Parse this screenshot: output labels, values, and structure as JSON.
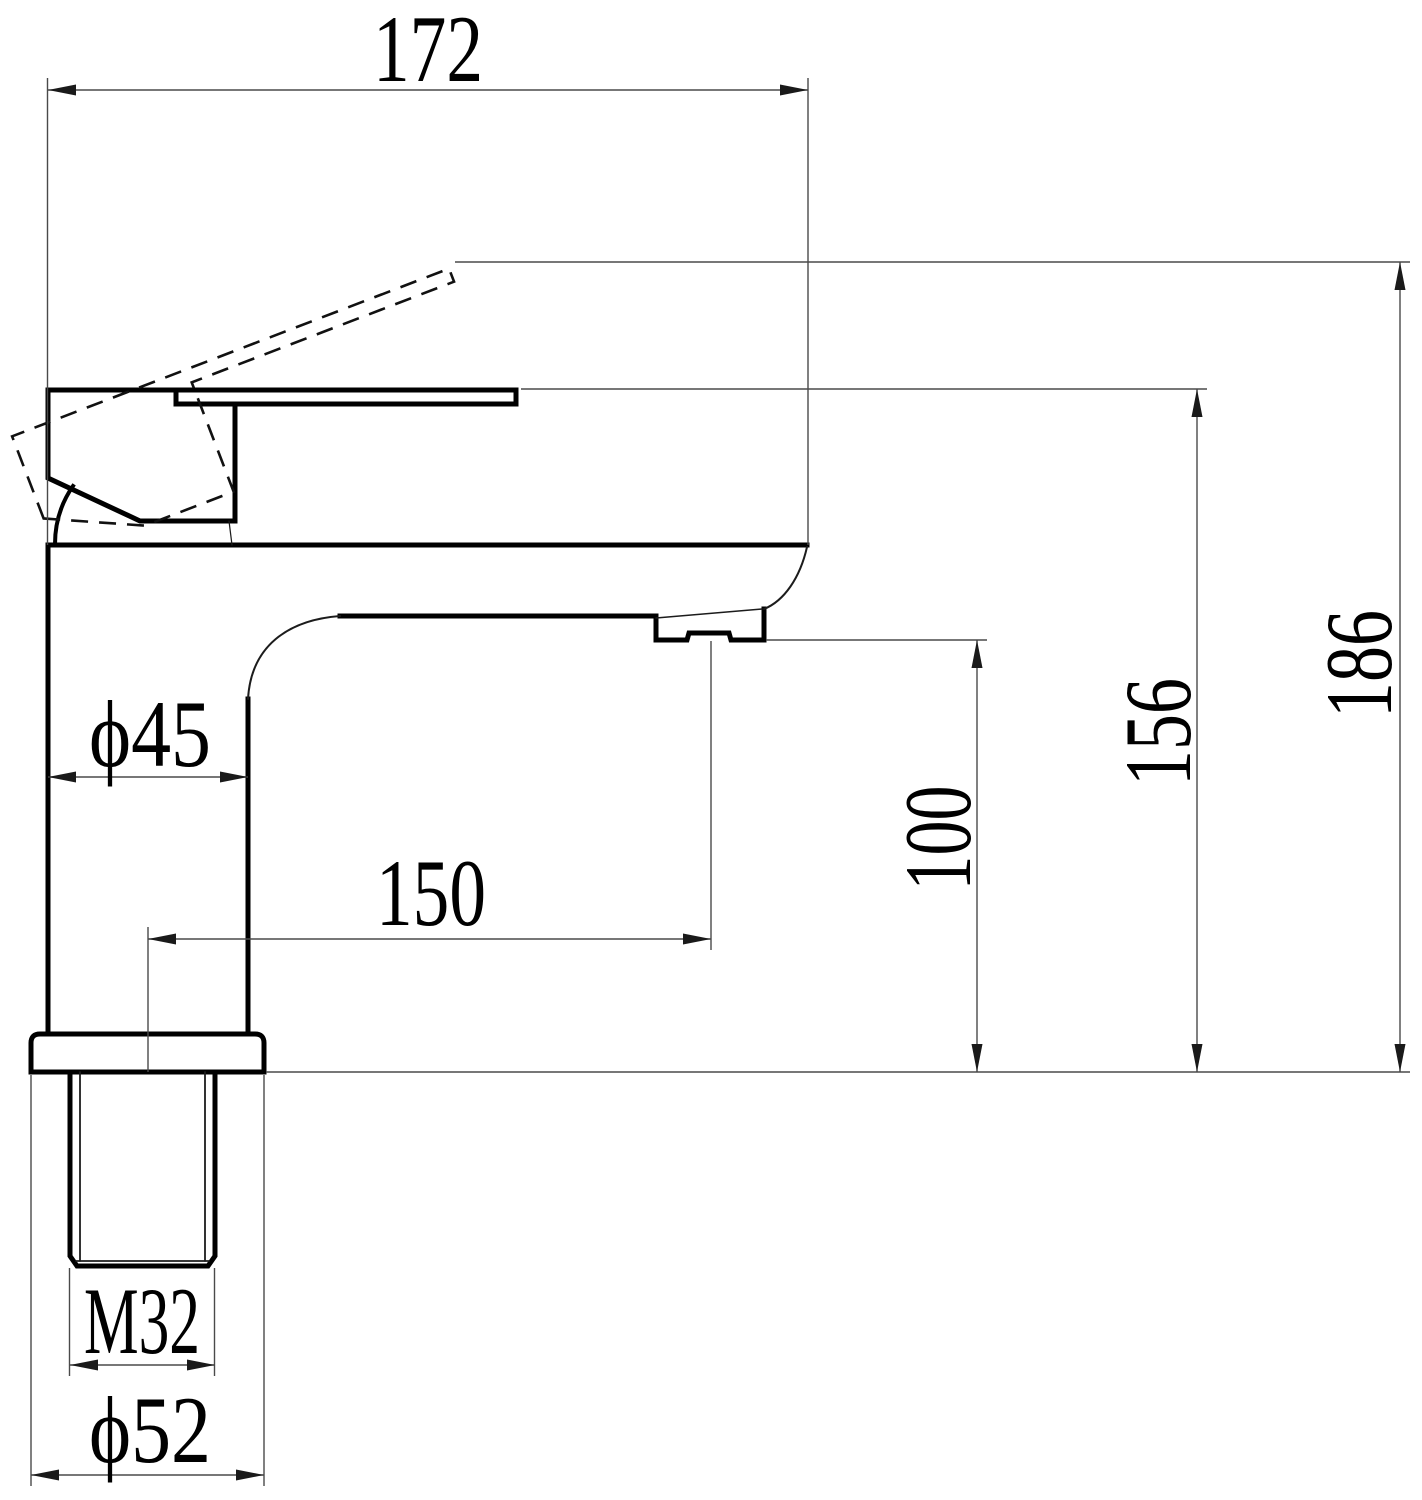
{
  "dims": {
    "top_width": "172",
    "total_height": "186",
    "body_top_height": "156",
    "spout_outlet_height": "100",
    "spout_reach": "150",
    "body_diameter": "ϕ45",
    "thread_size": "M32",
    "base_diameter": "ϕ52"
  },
  "colors": {
    "outline": "#000000",
    "thin_line": "#4a4a4a",
    "dashed_line": "#111111",
    "background": "#ffffff"
  }
}
